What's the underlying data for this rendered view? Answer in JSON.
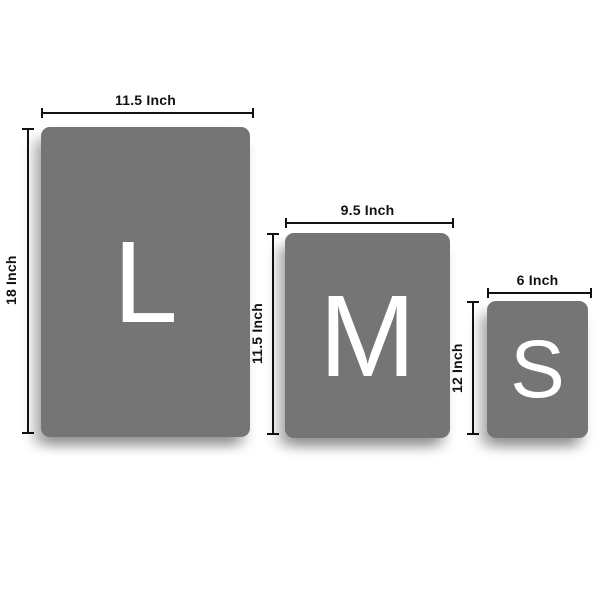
{
  "diagram": {
    "description": "Product size comparison chart with three sizes"
  },
  "sizes": [
    {
      "name": "Large",
      "letter": "L",
      "width_label": "11.5 Inch",
      "height_label": "18 Inch"
    },
    {
      "name": "Medium",
      "letter": "M",
      "width_label": "9.5 Inch",
      "height_label": "11.5 Inch"
    },
    {
      "name": "Small",
      "letter": "S",
      "width_label": "6 Inch",
      "height_label": "12 Inch"
    }
  ],
  "colors": {
    "panel": "#757575",
    "letter": "#ffffff",
    "dimension_line": "#111111",
    "background": "#ffffff"
  }
}
